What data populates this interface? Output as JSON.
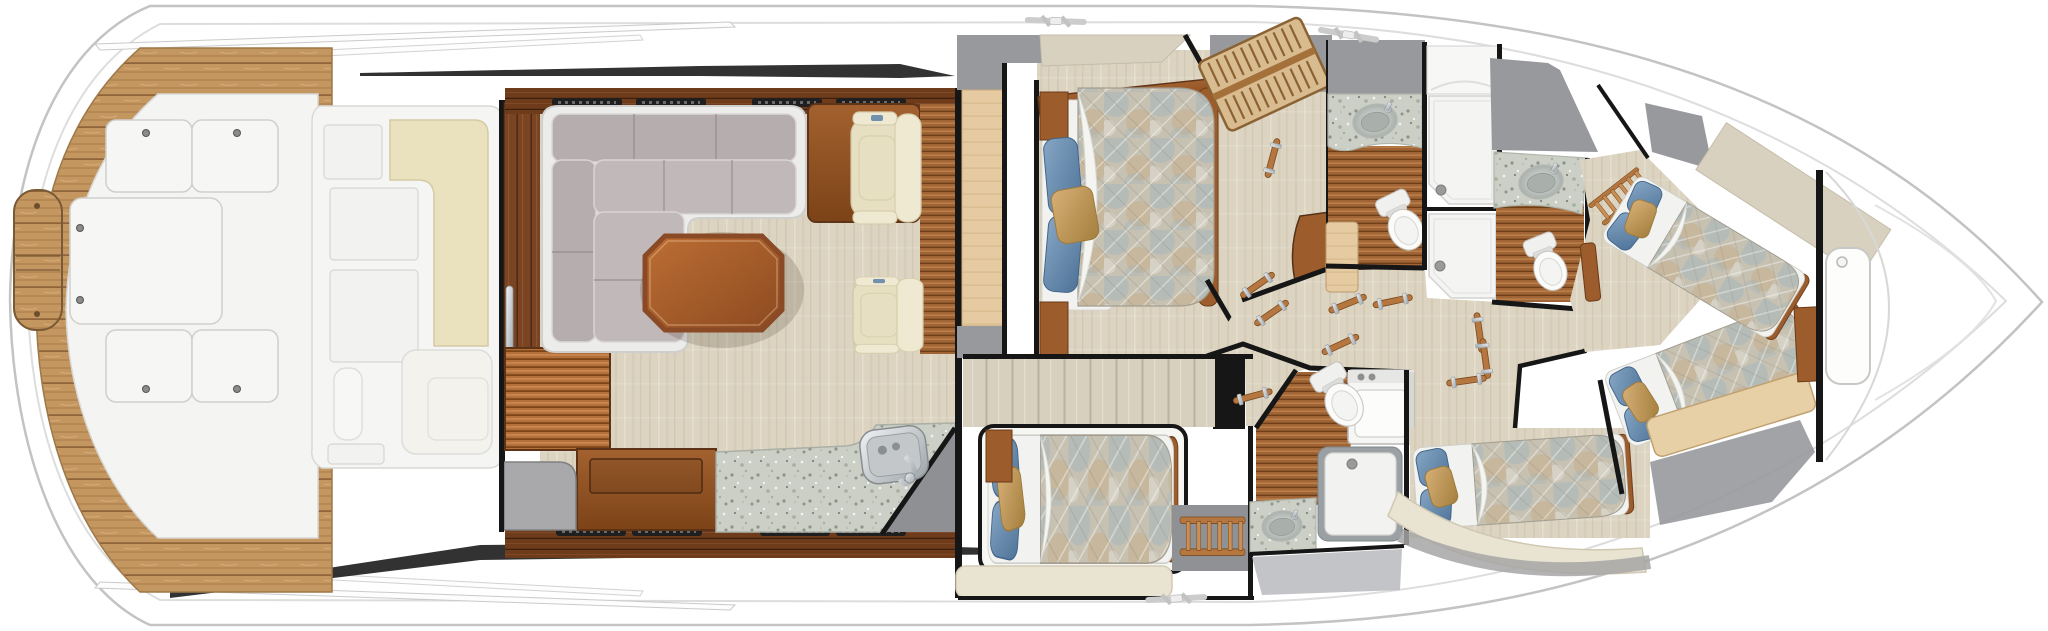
{
  "meta": {
    "diagram_type": "yacht-interior-floorplan",
    "view": "top-down",
    "bow_direction": "right",
    "canvas": {
      "width": 2048,
      "height": 631
    }
  },
  "palette": {
    "hull_white": "#ffffff",
    "hull_line": "#c3c3c3",
    "hull_inner_line": "#dddddd",
    "hull_stripe": "#1c1c1c",
    "teak": "#c59760",
    "teak_line": "#8a6036",
    "deck_panel": "#f4f4f2",
    "deck_panel_line": "#d4d4d2",
    "carpet": "#dcd4c1",
    "wood_dark": "#6e3b1b",
    "wood_medium": "#9c5c2b",
    "wood_light": "#c98f55",
    "maple": "#e6cba2",
    "cedar": "#b4703a",
    "granite": "#cbcfc6",
    "sofa": "#b6adaf",
    "sofa_seat": "#c1b8b9",
    "cream_cushion": "#eae1bf",
    "bench_cream": "#e9e3d2",
    "sheet_white": "#f2f3f0",
    "quilt_base": "#c7c1b2",
    "quilt_blue": "#9db4c0",
    "quilt_tan": "#c6ab84",
    "pillow_blue_1": "#86a6c4",
    "pillow_blue_2": "#4e7398",
    "pillow_tan_1": "#d6b077",
    "pillow_tan_2": "#a47e3c",
    "wall_black": "#161616",
    "panel_gray": "#98999c",
    "panel_gray_light": "#b9babd",
    "fixture_white": "#fbfbf9",
    "chrome_1": "#f0f2f4",
    "chrome_2": "#9ca3a8",
    "sink_basin": "#a9b0ac",
    "wall_panel_beige": "#d7d0bf",
    "canvas_beige": "#d8d1c0"
  },
  "inventory": {
    "areas": [
      {
        "name": "cockpit",
        "fixtures": [
          "teak-deck",
          "transom-platform-door",
          "deck-hatch x4",
          "center-deck-hatch"
        ]
      },
      {
        "name": "mezzanine",
        "fixtures": [
          "molded-seating",
          "cream-cushions",
          "storage-panels",
          "salon-entry-door",
          "chrome-door-handle"
        ]
      },
      {
        "name": "salon",
        "fixtures": [
          "l-shaped-sectional-sofa",
          "coffee-table",
          "club-chair x2",
          "side-console",
          "teak-holly-floor-strip",
          "air-vent x8"
        ]
      },
      {
        "name": "galley",
        "fixtures": [
          "granite-countertop",
          "stainless-sink",
          "faucet",
          "cooktop",
          "wood-credenza",
          "cedar-floor"
        ]
      },
      {
        "name": "master-stateroom",
        "fixtures": [
          "queen-berth",
          "blue-pillow x2",
          "accent-pillow",
          "nightstand x2",
          "dresser",
          "wardrobe",
          "companionway-stairs"
        ]
      },
      {
        "name": "corridor",
        "fixtures": [
          "grab-rail x8",
          "step-threshold"
        ]
      },
      {
        "name": "head-1",
        "fixtures": [
          "granite-vanity",
          "sink",
          "toilet",
          "shower-stall",
          "shower-drain",
          "teak-floor"
        ]
      },
      {
        "name": "head-2",
        "fixtures": [
          "granite-vanity",
          "sink",
          "toilet",
          "shower-stall",
          "shower-drain",
          "teak-floor",
          "berth-ladder"
        ]
      },
      {
        "name": "head-3",
        "fixtures": [
          "granite-vanity",
          "sink",
          "toilet",
          "shower-stall",
          "washer-dryer",
          "teak-floor"
        ]
      },
      {
        "name": "guest-cabin-aft",
        "fixtures": [
          "single-berth",
          "louvered-panel",
          "berth-ladder",
          "seat-bench"
        ]
      },
      {
        "name": "guest-cabin-mid",
        "fixtures": [
          "single-berth",
          "curved-seat-bench",
          "berth-ladder-niche"
        ]
      },
      {
        "name": "forward-cabin",
        "fixtures": [
          "crossed-berth-port",
          "crossed-berth-starboard",
          "berth-step-board",
          "berth-ladder"
        ]
      },
      {
        "name": "bow-deck",
        "fixtures": [
          "deck-hatch",
          "bow-bulkhead"
        ]
      }
    ],
    "cleat_count": 3
  }
}
